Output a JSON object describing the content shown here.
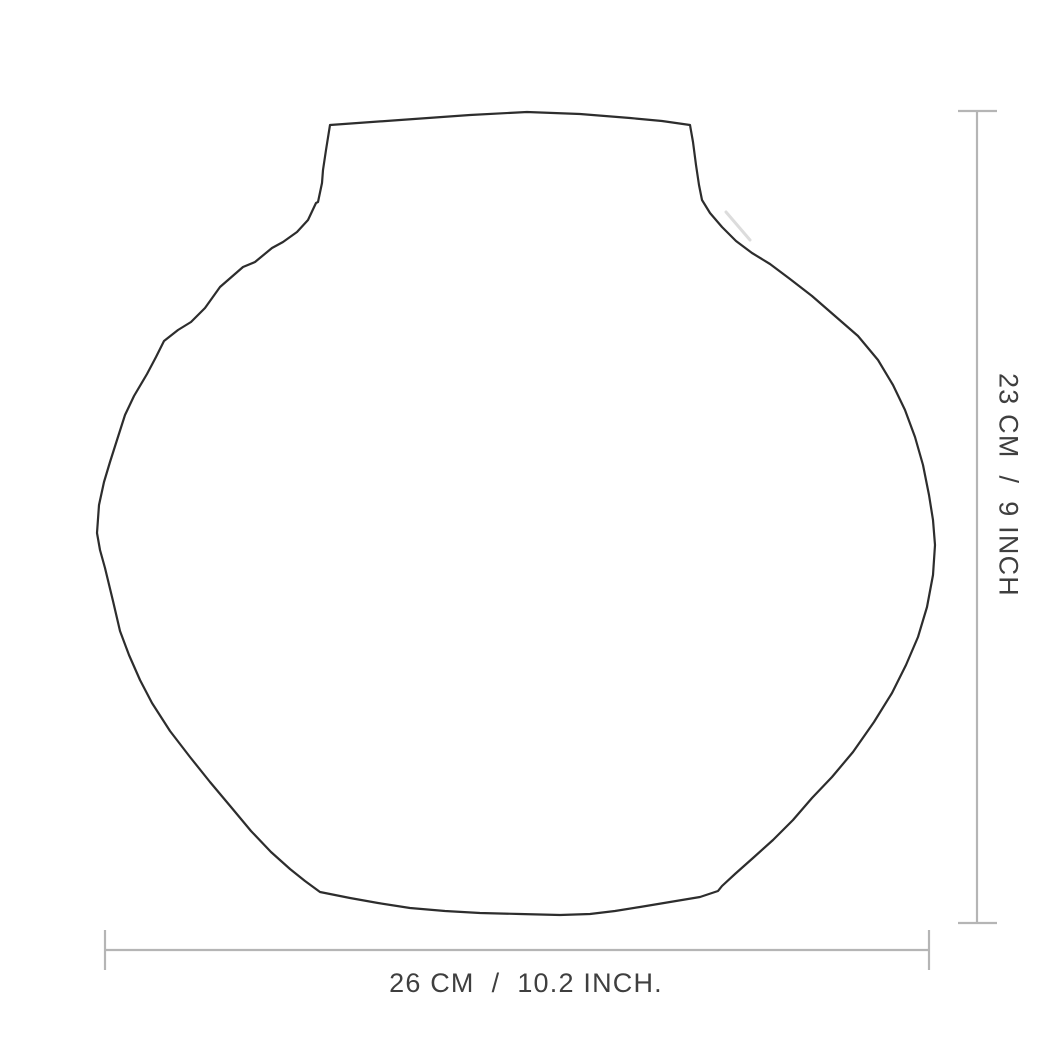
{
  "diagram": {
    "subject": "vase-outline-drawing",
    "vertical_dimension": {
      "cm": "23 CM",
      "separator": "/",
      "inch": "9 INCH"
    },
    "horizontal_dimension": {
      "cm": "26 CM",
      "separator": "/",
      "inch": "10.2 INCH."
    },
    "colors": {
      "background": "#ffffff",
      "outline": "#2d2d2d",
      "dimension_line": "#b5b5b5",
      "label_text": "#3f3f3f"
    }
  }
}
